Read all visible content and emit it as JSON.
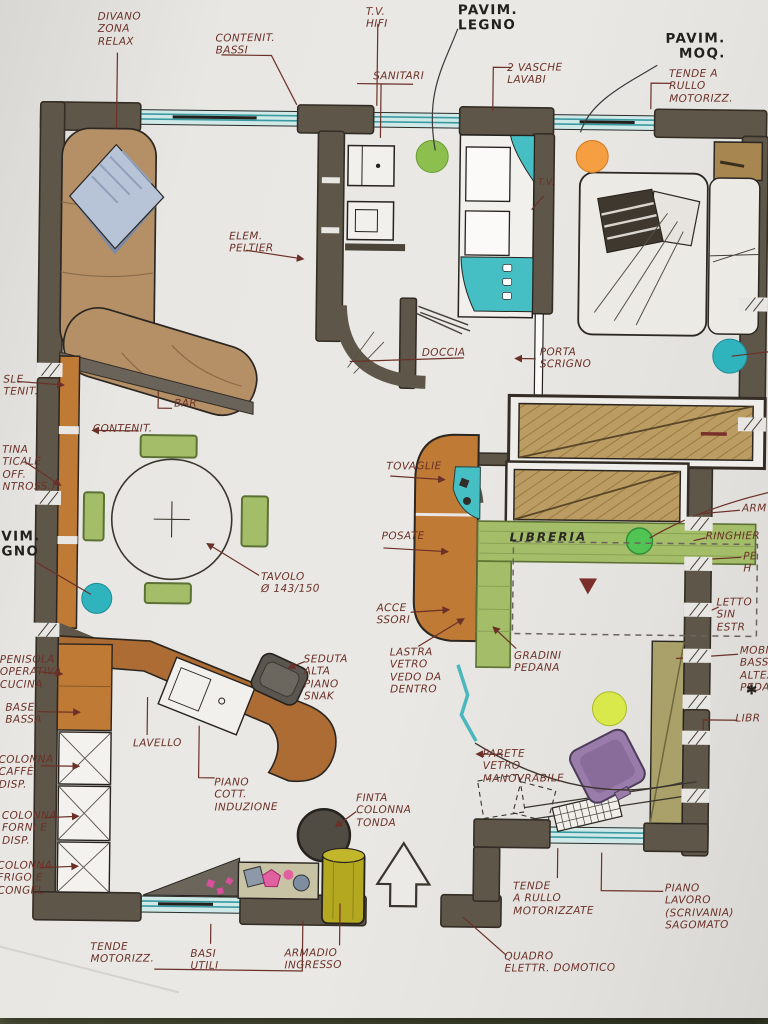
{
  "colors": {
    "paper": "#e9e7e3",
    "background_couch": "#4c503a",
    "wall": "#5e5749",
    "wood_tan": "#bb9c62",
    "wood_orange": "#bf7a36",
    "sofa_tan": "#b59067",
    "green_furniture": "#a3bd69",
    "window_teal": "#9fd6d8",
    "dot_green": "#8cbf4e",
    "dot_orange": "#f59e42",
    "dot_teal": "#2fb3bc",
    "dot_lime": "#d9e84b",
    "dot_bright_green": "#52c453",
    "chair_purple": "#9a7cab",
    "cabinet_yellow": "#b3a820",
    "label_ink": "#6b3028",
    "bold_ink": "#23211e"
  },
  "icons": {
    "north_arrow": "up-arrow-outline",
    "asterisk_mark": "✱"
  },
  "labels": {
    "divano": {
      "text": "DIVANO\nZONA\nRELAX"
    },
    "contenit_bassi": {
      "text": "CONTENIT.\nBASSI"
    },
    "tv_hifi": {
      "text": "T.V.\nHIFI"
    },
    "pavim_legno": {
      "text": "PAVIM.\nLEGNO"
    },
    "sanitari": {
      "text": "SANITARI"
    },
    "vasche": {
      "text": "2 VASCHE\nLAVABI"
    },
    "pavim_moq": {
      "text": "PAVIM.\nMOQ."
    },
    "tenda_rullo_top": {
      "text": "TENDE A\nRULLO\nMOTORIZZ."
    },
    "elem_peltier": {
      "text": "ELEM.\nPELTIER"
    },
    "tv_small": {
      "text": "T.V."
    },
    "doccia": {
      "text": "DOCCIA"
    },
    "porta_scrigno": {
      "text": "PORTA\nSCRIGNO"
    },
    "bar": {
      "text": "BAR"
    },
    "contenit": {
      "text": "CONTENIT."
    },
    "cut_console": {
      "text": "SLE\nTENIT."
    },
    "cut_vetrina": {
      "text": "TINA\nTICALE\nOFF.\nNTROSS.)"
    },
    "cut_pavim": {
      "text": "VIM.\nGNO"
    },
    "tovaglie": {
      "text": "TOVAGLIE"
    },
    "posate": {
      "text": "POSATE"
    },
    "tavolo": {
      "text": "TAVOLO\nØ 143/150"
    },
    "libreria": {
      "text": "LIBRERIA"
    },
    "accessori": {
      "text": "ACCE\nSSORI"
    },
    "lastra": {
      "text": "LASTRA\nVETRO\nVEDO DA\nDENTRO"
    },
    "gradini": {
      "text": "GRADINI\nPEDANA"
    },
    "seduta": {
      "text": "SEDUTA\nALTA\nPIANO\nSNAK"
    },
    "penisola": {
      "text": "PENISOLA\nOPERATIVA\nCUCINA"
    },
    "base_bassa": {
      "text": "BASE\nBASSA"
    },
    "col_caffe": {
      "text": "COLONNA\nCAFFÈ\nDISP."
    },
    "col_forni": {
      "text": "COLONNA\nFORNI E\nDISP."
    },
    "col_frigo": {
      "text": "COLONNA\nFRIGO E\nCONGEL"
    },
    "lavello": {
      "text": "LAVELLO"
    },
    "piano_cott": {
      "text": "PIANO\nCOTT.\nINDUZIONE"
    },
    "finta_colonna": {
      "text": "FINTA\nCOLONNA\nTONDA"
    },
    "parete_vetro": {
      "text": "PARETE\nVETRO\nMANOVRABILE"
    },
    "tende_rullo_bottom": {
      "text": "TENDE\nA RULLO\nMOTORIZZATE"
    },
    "piano_lavoro": {
      "text": "PIANO\nLAVORO (SCRIVANIA)\nSAGOMATO"
    },
    "quadro": {
      "text": "QUADRO\nELETTR. DOMOTICO"
    },
    "tende_motoriz": {
      "text": "TENDE\nMOTORIZZ."
    },
    "basi_utili": {
      "text": "BASI\nUTILI"
    },
    "armadio_ingresso": {
      "text": "ARMADIO\nINGRESSO"
    },
    "cut_armadio": {
      "text": "ARM"
    },
    "cut_ringhiera": {
      "text": "RINGHIER"
    },
    "cut_pedana": {
      "text": "PE\nH"
    },
    "cut_letto": {
      "text": "LETTO SIN\nESTR"
    },
    "cut_mobile": {
      "text": "MOBIL\nBASSO\nALTEZZ\nPEDAN"
    },
    "asterisk": {
      "text": "✱"
    },
    "cut_libreria": {
      "text": "LIBR"
    }
  }
}
